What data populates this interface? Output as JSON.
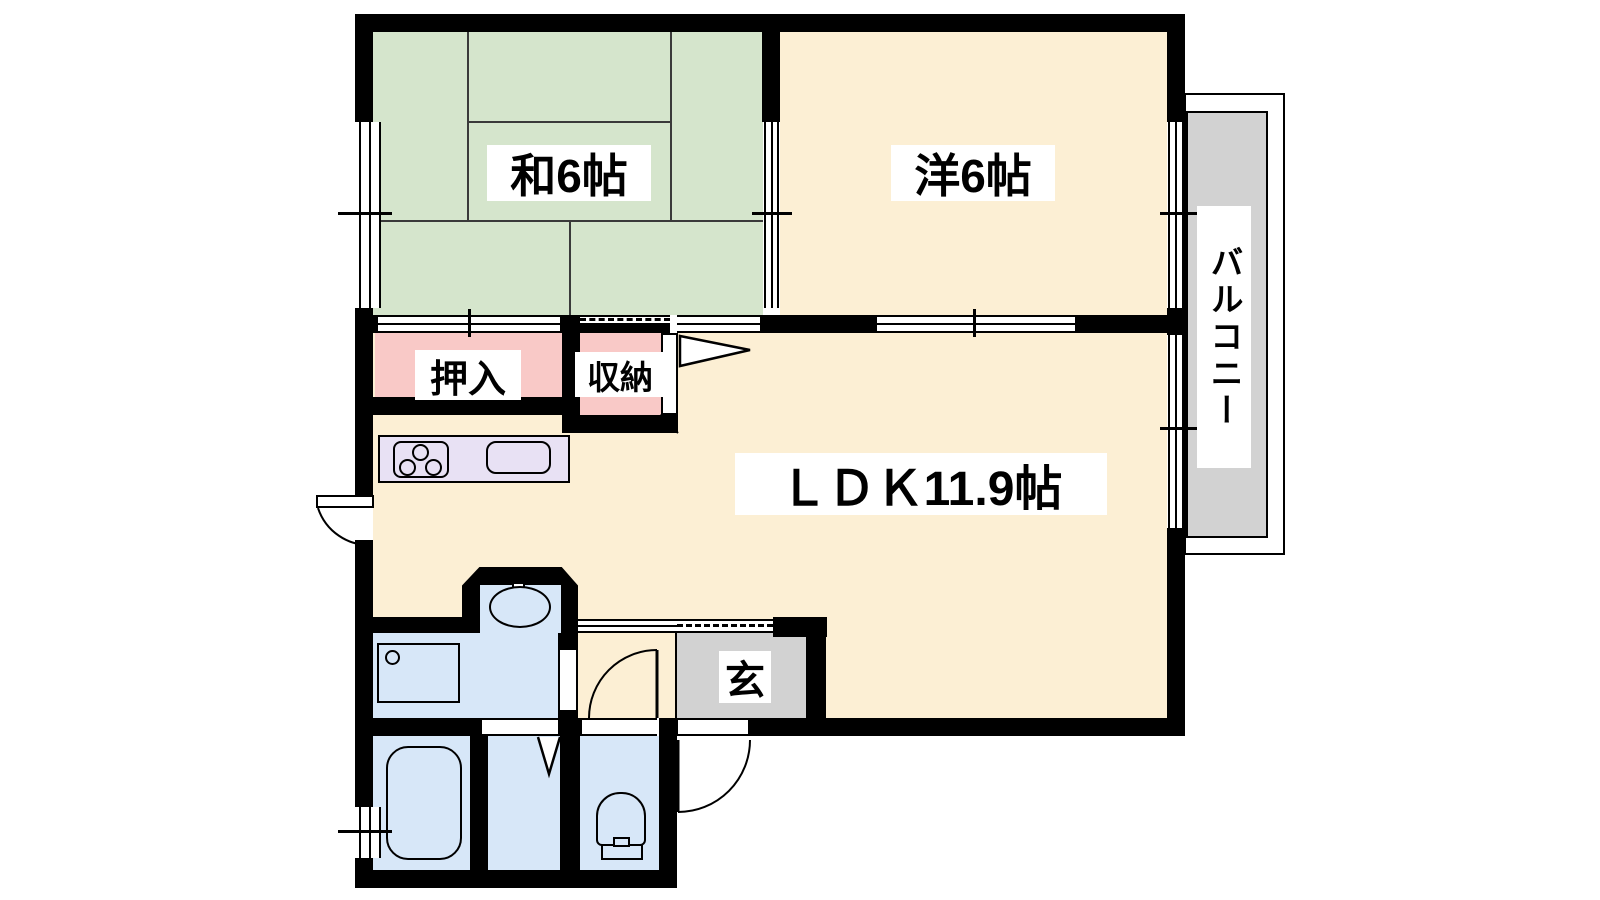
{
  "page": {
    "type": "apartment-floor-plan",
    "layout_name": "2LDK unit floor plan"
  },
  "colors": {
    "wall": "#000000",
    "tatami_green": "#d5e5cc",
    "flooring_cream": "#fcefd4",
    "closet_pink": "#f9c9c7",
    "kitchen_lavender": "#e8e1f4",
    "bath_blue": "#d7e7f8",
    "entrance_gray": "#d2d2d2",
    "balcony_gray": "#d2d2d2",
    "background": "#ffffff"
  },
  "rooms": {
    "japanese_room": {
      "label": "和6帖",
      "type": "japanese tatami room",
      "size_mats": 6
    },
    "western_room": {
      "label": "洋6帖",
      "type": "western room",
      "size_mats": 6
    },
    "ldk": {
      "label": "ＬＤＫ11.9帖",
      "type": "living-dining-kitchen",
      "size_mats": 11.9
    },
    "closet_oshiire": {
      "label": "押入",
      "type": "futon closet"
    },
    "closet_shuno": {
      "label": "収納",
      "type": "storage"
    },
    "entrance": {
      "label": "玄",
      "type": "genkan entrance"
    },
    "balcony": {
      "label": "バルコニー",
      "type": "balcony"
    }
  }
}
